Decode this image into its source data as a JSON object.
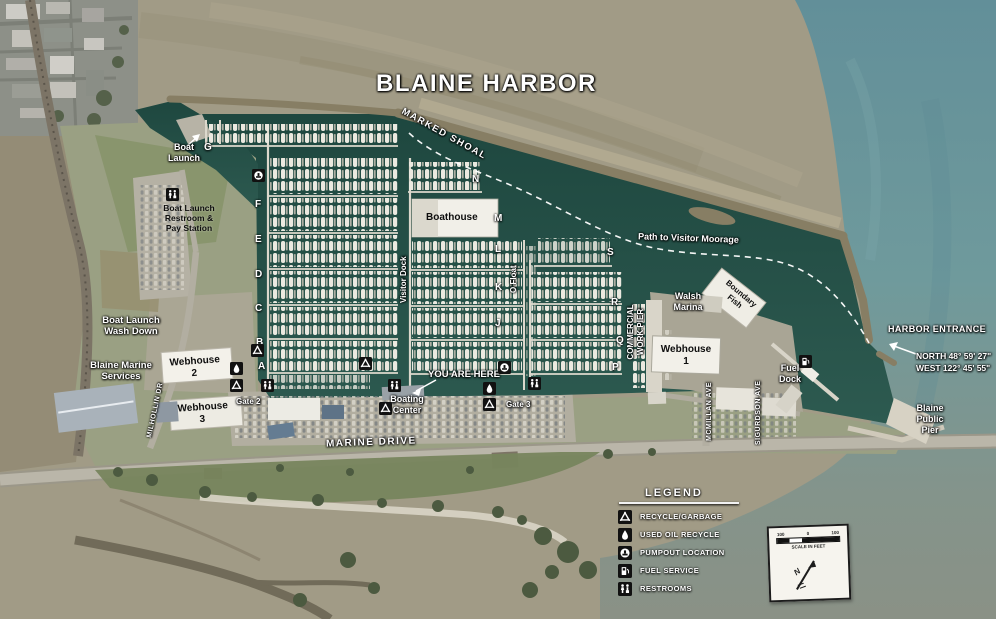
{
  "title": "BLAINE HARBOR",
  "labels": {
    "marked_shoal": "MARKED SHOAL",
    "path_visitor": "Path to Visitor Moorage",
    "harbor_entrance": "HARBOR ENTRANCE",
    "coords": "NORTH 48° 59' 27\"\nWEST 122° 45' 55\"",
    "blaine_public_pier": "Blaine\nPublic\nPier",
    "fuel_dock": "Fuel\nDock",
    "boat_launch": "Boat\nLaunch",
    "launch_restroom": "Boat Launch\nRestroom &\nPay Station",
    "wash_down": "Boat Launch\nWash Down",
    "marine_services": "Blaine Marine\nServices",
    "webhouse1": "Webhouse\n1",
    "webhouse2": "Webhouse\n2",
    "webhouse3": "Webhouse\n3",
    "walsh_marina": "Walsh\nMarina",
    "boundary_fish": "Boundary\nFish",
    "boathouse": "Boathouse",
    "visitor_dock": "Visitor Dock",
    "o_float": "O Float",
    "commercial_pier": "COMMERCIAL\nWORK PIER",
    "mcmillan": "MCMILLAN AVE",
    "sigurdson": "SIGURDSON AVE",
    "milhollin": "MILHOLLIN DR",
    "marine_drive": "MARINE DRIVE",
    "you_are_here": "YOU ARE HERE",
    "boating_center": "Boating\nCenter",
    "gate2": "Gate 2",
    "gate3": "Gate 3"
  },
  "dock_letters": [
    {
      "letter": "G",
      "x": 204,
      "y": 142
    },
    {
      "letter": "F",
      "x": 255,
      "y": 199
    },
    {
      "letter": "E",
      "x": 255,
      "y": 234
    },
    {
      "letter": "D",
      "x": 255,
      "y": 269
    },
    {
      "letter": "C",
      "x": 255,
      "y": 303
    },
    {
      "letter": "B",
      "x": 256,
      "y": 337
    },
    {
      "letter": "A",
      "x": 258,
      "y": 361
    },
    {
      "letter": "N",
      "x": 472,
      "y": 174
    },
    {
      "letter": "M",
      "x": 494,
      "y": 213
    },
    {
      "letter": "L",
      "x": 495,
      "y": 244
    },
    {
      "letter": "K",
      "x": 495,
      "y": 282
    },
    {
      "letter": "J",
      "x": 495,
      "y": 318
    },
    {
      "letter": "S",
      "x": 607,
      "y": 247
    },
    {
      "letter": "R",
      "x": 611,
      "y": 297
    },
    {
      "letter": "Q",
      "x": 616,
      "y": 335
    },
    {
      "letter": "P",
      "x": 612,
      "y": 362
    }
  ],
  "map_icons": [
    {
      "type": "restroom",
      "x": 166,
      "y": 188
    },
    {
      "type": "pumpout",
      "x": 252,
      "y": 169
    },
    {
      "type": "recycle",
      "x": 251,
      "y": 344
    },
    {
      "type": "oil",
      "x": 230,
      "y": 362
    },
    {
      "type": "recycle",
      "x": 230,
      "y": 379
    },
    {
      "type": "restroom",
      "x": 261,
      "y": 379
    },
    {
      "type": "recycle",
      "x": 359,
      "y": 357
    },
    {
      "type": "restroom",
      "x": 388,
      "y": 379
    },
    {
      "type": "recycle",
      "x": 379,
      "y": 402
    },
    {
      "type": "pumpout",
      "x": 498,
      "y": 361
    },
    {
      "type": "oil",
      "x": 483,
      "y": 382
    },
    {
      "type": "recycle",
      "x": 483,
      "y": 398
    },
    {
      "type": "restroom",
      "x": 528,
      "y": 377
    },
    {
      "type": "fuel",
      "x": 799,
      "y": 355
    }
  ],
  "legend": {
    "title": "LEGEND",
    "items": [
      {
        "icon": "recycle",
        "label": "RECYCLE/GARBAGE"
      },
      {
        "icon": "oil",
        "label": "USED OIL RECYCLE"
      },
      {
        "icon": "pumpout",
        "label": "PUMPOUT LOCATION"
      },
      {
        "icon": "fuel",
        "label": "FUEL SERVICE"
      },
      {
        "icon": "restroom",
        "label": "RESTROOMS"
      }
    ]
  },
  "scale_box": {
    "ticks": [
      "100",
      "0",
      "100"
    ],
    "caption": "SCALE IN FEET",
    "north_label": "N"
  },
  "colors": {
    "harbor_water": "#23504a",
    "open_sea": "#6d99a1",
    "tidal_flats": "#a19b86",
    "label_white": "#ffffff",
    "icon_black": "#111111"
  }
}
